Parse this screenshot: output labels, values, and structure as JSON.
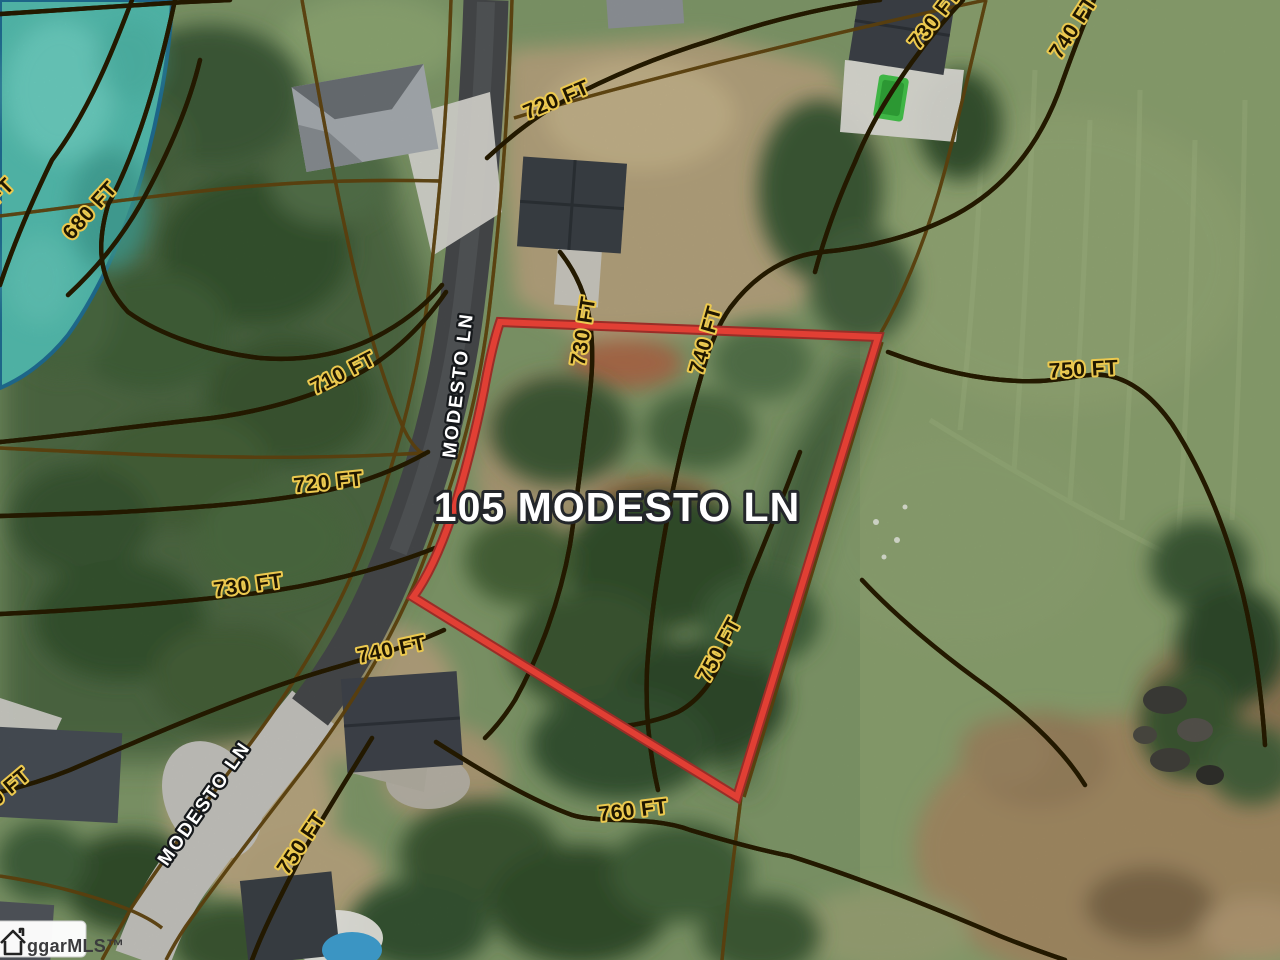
{
  "map": {
    "parcel_label": {
      "text": "105 MODESTO LN"
    },
    "road_labels": [
      {
        "text": "MODESTO LN"
      },
      {
        "text": "MODESTO LN"
      }
    ],
    "contour_labels": [
      {
        "text": "680 FT"
      },
      {
        "text": "FT"
      },
      {
        "text": "710 FT"
      },
      {
        "text": "720 FT"
      },
      {
        "text": "730 FT"
      },
      {
        "text": "740 FT"
      },
      {
        "text": "0 FT"
      },
      {
        "text": "750 FT"
      },
      {
        "text": "720 FT"
      },
      {
        "text": "730 FT"
      },
      {
        "text": "740 FT"
      },
      {
        "text": "730 FT"
      },
      {
        "text": "740 FT"
      },
      {
        "text": "750 FT"
      },
      {
        "text": "750 FT"
      },
      {
        "text": "760 FT"
      }
    ],
    "watermark": {
      "text": "ggarMLS™"
    },
    "colors": {
      "parcel_boundary": "#ee4136",
      "contour_line": "#e8c751",
      "lot_line": "#d5912f",
      "water": "#54bcae"
    }
  }
}
